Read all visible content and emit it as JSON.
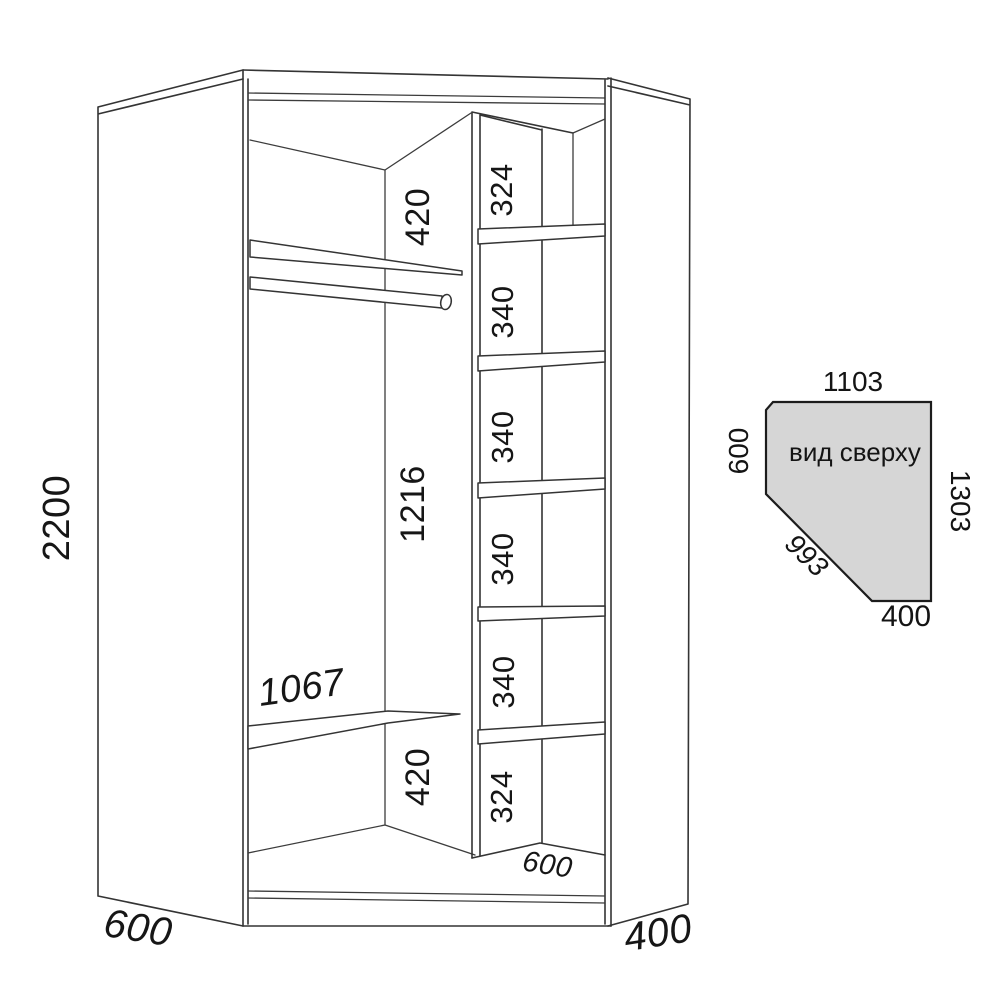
{
  "meta": {
    "background_color": "#ffffff",
    "line_color": "#343434",
    "text_color": "#161616"
  },
  "front_view": {
    "overall_height": "2200",
    "left_side_width": "600",
    "right_side_depth": "400",
    "shelf_width": "1067",
    "left_sections": {
      "top": "420",
      "middle": "1216",
      "bottom": "420"
    },
    "shelf_column": {
      "sections": [
        "324",
        "340",
        "340",
        "340",
        "340",
        "324"
      ],
      "column_depth": "600"
    }
  },
  "top_view": {
    "title": "вид сверху",
    "fill_color": "#d6d6d6",
    "top_edge": "1103",
    "left_edge": "600",
    "right_edge": "1303",
    "diagonal_edge": "993",
    "bottom_edge": "400"
  }
}
